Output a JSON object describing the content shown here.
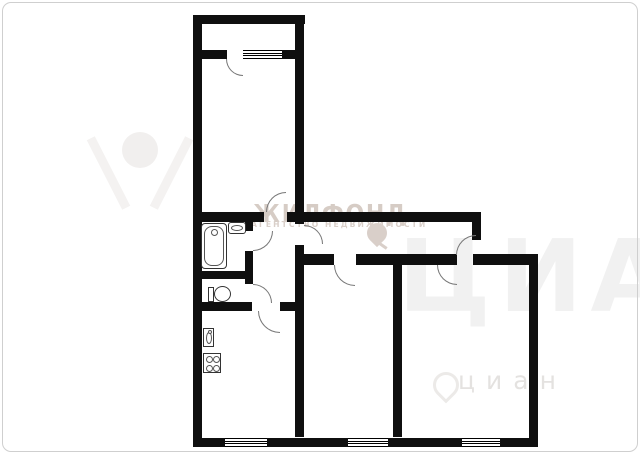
{
  "image": {
    "kind": "apartment floor plan (3-room flat, no text labels on rooms)",
    "background": "#ffffff",
    "wall_color": "#0f0f0f",
    "border_color": "#cfcfcf"
  },
  "watermarks": {
    "zhilfond": {
      "title": "ЖИЛФОНД",
      "subtitle": "АГЕНТСТВО НЕДВИЖИМОСТИ",
      "color": "#d6ccc5"
    },
    "cian": {
      "small": "циан",
      "giant": "ЦИАН",
      "color_small": "#e4e2e0",
      "color_giant": "#f1f1f1"
    }
  }
}
